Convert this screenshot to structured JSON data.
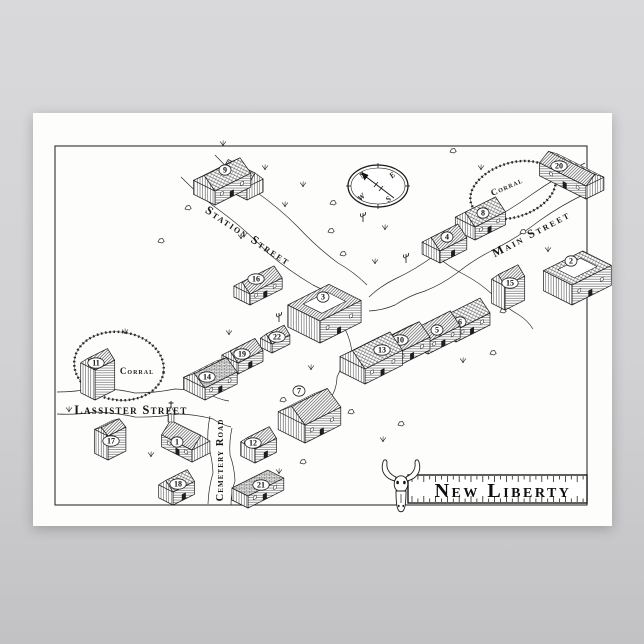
{
  "page": {
    "bg_top": "#d9d9db",
    "bg_bottom": "#c2c2c4"
  },
  "poster": {
    "bg": "#fdfdfc",
    "ink": "#1b1b1b",
    "border_color": "#2f2f2f"
  },
  "map": {
    "title": "New Liberty",
    "streets": [
      {
        "id": "station-street",
        "label": "Station Street"
      },
      {
        "id": "main-street",
        "label": "Main Street"
      },
      {
        "id": "lassister-street",
        "label": "Lassister Street"
      },
      {
        "id": "cemetery-road",
        "label": "Cemetery Road"
      }
    ],
    "corral_label": "Corral",
    "compass_letters": [
      "N",
      "E",
      "S",
      "W"
    ],
    "compass": {
      "cx": 345,
      "cy": 73,
      "rx": 30,
      "ry": 21
    },
    "border": {
      "x": 22,
      "y": 33,
      "w": 532,
      "h": 359
    },
    "banner": {
      "x": 375,
      "y": 362,
      "w": 179,
      "h": 28,
      "tx": 470,
      "ty": 384
    },
    "corrals": [
      {
        "cx": 480,
        "cy": 77,
        "rx": 44,
        "ry": 27,
        "rot": -18,
        "lx": 475,
        "ly": 76,
        "lrot": -24
      },
      {
        "cx": 86,
        "cy": 253,
        "rx": 45,
        "ry": 34,
        "rot": 8,
        "lx": 104,
        "ly": 261,
        "lrot": 0
      }
    ],
    "buildings": [
      {
        "num": "20",
        "o": "se",
        "x": 553,
        "y": 86,
        "a": 52,
        "b": 20,
        "h": 13,
        "r": 7,
        "roof": "a",
        "nx": 526,
        "ny": 53
      },
      {
        "num": "",
        "name": "station-wing",
        "o": "se",
        "x": 214,
        "y": 87,
        "a": 30,
        "b": 18,
        "h": 13,
        "r": 10,
        "roof": "b"
      },
      {
        "num": "9",
        "name": "station",
        "o": "ne",
        "x": 182,
        "y": 92,
        "a": 40,
        "b": 24,
        "h": 14,
        "r": 10,
        "roof": "shake",
        "nx": 192,
        "ny": 57
      },
      {
        "num": "8",
        "o": "ne",
        "x": 442,
        "y": 127,
        "a": 34,
        "b": 22,
        "h": 13,
        "r": 10,
        "roof": "shake",
        "nx": 450,
        "ny": 100
      },
      {
        "num": "4",
        "o": "ne",
        "x": 407,
        "y": 150,
        "a": 30,
        "b": 20,
        "h": 12,
        "r": 9,
        "roof": "a",
        "nx": 414,
        "ny": 124
      },
      {
        "num": "15",
        "o": "ne",
        "x": 472,
        "y": 197,
        "a": 22,
        "b": 15,
        "h": 24,
        "r": 8,
        "roof": "a",
        "nx": 477,
        "ny": 170
      },
      {
        "num": "2",
        "o": "ne",
        "x": 539,
        "y": 192,
        "a": 44,
        "b": 32,
        "h": 20,
        "roof": "shake",
        "style": "flat",
        "court": true,
        "nx": 538,
        "ny": 148
      },
      {
        "num": "16",
        "o": "ne",
        "x": 217,
        "y": 192,
        "a": 36,
        "b": 18,
        "h": 11,
        "r": 8,
        "roof": "a",
        "nx": 223,
        "ny": 166
      },
      {
        "num": "3",
        "o": "ne",
        "x": 287,
        "y": 230,
        "a": 46,
        "b": 36,
        "h": 22,
        "roof": "a",
        "style": "flat",
        "court": true,
        "nx": 290,
        "ny": 184
      },
      {
        "num": "6",
        "o": "ne",
        "x": 423,
        "y": 229,
        "a": 38,
        "b": 22,
        "h": 12,
        "r": 10,
        "roof": "shake",
        "nx": 427,
        "ny": 209
      },
      {
        "num": "5",
        "o": "ne",
        "x": 395,
        "y": 241,
        "a": 36,
        "b": 22,
        "h": 12,
        "r": 10,
        "roof": "a",
        "nx": 404,
        "ny": 217
      },
      {
        "num": "10",
        "o": "ne",
        "x": 363,
        "y": 254,
        "a": 38,
        "b": 24,
        "h": 13,
        "r": 10,
        "roof": "a",
        "nx": 367,
        "ny": 227
      },
      {
        "num": "13",
        "o": "ne",
        "x": 332,
        "y": 271,
        "a": 42,
        "b": 28,
        "h": 15,
        "r": 12,
        "roof": "shake",
        "nx": 349,
        "ny": 237
      },
      {
        "num": "22",
        "o": "ne",
        "x": 239,
        "y": 240,
        "a": 20,
        "b": 13,
        "h": 9,
        "r": 7,
        "roof": "a",
        "nx": 244,
        "ny": 224
      },
      {
        "num": "19",
        "o": "ne",
        "x": 205,
        "y": 261,
        "a": 28,
        "b": 18,
        "h": 11,
        "r": 8,
        "roof": "a",
        "nx": 209,
        "ny": 241
      },
      {
        "num": "14",
        "o": "ne",
        "x": 172,
        "y": 287,
        "a": 36,
        "b": 24,
        "h": 12,
        "r": 9,
        "roof": "brick",
        "nx": 174,
        "ny": 264
      },
      {
        "num": "11",
        "o": "ne",
        "x": 62,
        "y": 287,
        "a": 22,
        "b": 16,
        "h": 30,
        "r": 8,
        "roof": "a",
        "nx": 63,
        "ny": 250
      },
      {
        "num": "7",
        "o": "ne",
        "x": 272,
        "y": 330,
        "a": 40,
        "b": 30,
        "h": 18,
        "r": 12,
        "roof": "a",
        "nx": 266,
        "ny": 278
      },
      {
        "num": "12",
        "o": "ne",
        "x": 222,
        "y": 350,
        "a": 24,
        "b": 16,
        "h": 14,
        "r": 8,
        "roof": "a",
        "nx": 220,
        "ny": 330
      },
      {
        "num": "17",
        "o": "ne",
        "x": 75,
        "y": 347,
        "a": 20,
        "b": 15,
        "h": 24,
        "r": 5,
        "roof": "a",
        "nx": 78,
        "ny": 328
      },
      {
        "num": "1",
        "o": "se",
        "x": 159,
        "y": 349,
        "a": 34,
        "b": 20,
        "h": 12,
        "r": 10,
        "roof": "a",
        "tower": [
          138,
          309
        ],
        "nx": 144,
        "ny": 329
      },
      {
        "num": "18",
        "o": "ne",
        "x": 140,
        "y": 392,
        "a": 24,
        "b": 16,
        "h": 13,
        "r": 8,
        "roof": "shake",
        "nx": 145,
        "ny": 371
      },
      {
        "num": "21",
        "o": "ne",
        "x": 215,
        "y": 395,
        "a": 40,
        "b": 18,
        "h": 12,
        "roof": "brick",
        "style": "flat",
        "nx": 228,
        "ny": 372
      }
    ],
    "roads": [
      {
        "pts": [
          [
            148,
            64
          ],
          [
            190,
            100
          ],
          [
            235,
            140
          ],
          [
            280,
            172
          ],
          [
            312,
            192
          ]
        ],
        "amp": 2.5
      },
      {
        "pts": [
          [
            182,
            42
          ],
          [
            222,
            78
          ],
          [
            265,
            114
          ],
          [
            305,
            150
          ],
          [
            334,
            172
          ]
        ],
        "amp": 2.5
      },
      {
        "pts": [
          [
            552,
            50
          ],
          [
            498,
            82
          ],
          [
            448,
            112
          ],
          [
            402,
            142
          ],
          [
            362,
            166
          ],
          [
            336,
            184
          ]
        ],
        "amp": 2.5
      },
      {
        "pts": [
          [
            554,
            80
          ],
          [
            506,
            108
          ],
          [
            462,
            136
          ],
          [
            424,
            160
          ],
          [
            392,
            178
          ],
          [
            362,
            192
          ],
          [
            336,
            198
          ]
        ],
        "amp": 2.5
      },
      {
        "pts": [
          [
            402,
            142
          ],
          [
            432,
            162
          ],
          [
            460,
            182
          ],
          [
            486,
            202
          ],
          [
            500,
            216
          ]
        ],
        "amp": 2.2
      },
      {
        "pts": [
          [
            24,
            279
          ],
          [
            62,
            275
          ],
          [
            102,
            280
          ],
          [
            142,
            276
          ],
          [
            176,
            281
          ],
          [
            196,
            288
          ]
        ],
        "amp": 2
      },
      {
        "pts": [
          [
            24,
            301
          ],
          [
            62,
            299
          ],
          [
            102,
            304
          ],
          [
            146,
            301
          ],
          [
            180,
            306
          ],
          [
            198,
            314
          ]
        ],
        "amp": 2
      },
      {
        "pts": [
          [
            177,
            303
          ],
          [
            175,
            332
          ],
          [
            180,
            360
          ],
          [
            175,
            391
          ]
        ],
        "amp": 2
      },
      {
        "pts": [
          [
            199,
            315
          ],
          [
            197,
            342
          ],
          [
            202,
            368
          ],
          [
            198,
            392
          ]
        ],
        "amp": 2
      },
      {
        "pts": [
          [
            322,
            192
          ],
          [
            312,
            216
          ],
          [
            319,
            240
          ],
          [
            304,
            264
          ],
          [
            299,
            283
          ]
        ],
        "amp": 2.4
      },
      {
        "pts": [
          [
            60,
            247
          ],
          [
            72,
            262
          ],
          [
            64,
            276
          ]
        ],
        "amp": 1.5
      }
    ],
    "scatter": [
      [
        155,
        95,
        "r"
      ],
      [
        128,
        128,
        "r"
      ],
      [
        190,
        33,
        "g"
      ],
      [
        232,
        57,
        "g"
      ],
      [
        208,
        126,
        "g"
      ],
      [
        252,
        94,
        "g"
      ],
      [
        298,
        118,
        "r"
      ],
      [
        330,
        106,
        "c"
      ],
      [
        352,
        117,
        "g"
      ],
      [
        310,
        141,
        "r"
      ],
      [
        342,
        151,
        "g"
      ],
      [
        373,
        147,
        "c"
      ],
      [
        398,
        131,
        "r"
      ],
      [
        300,
        90,
        "r"
      ],
      [
        270,
        74,
        "g"
      ],
      [
        420,
        38,
        "r"
      ],
      [
        448,
        57,
        "g"
      ],
      [
        490,
        119,
        "r"
      ],
      [
        515,
        139,
        "g"
      ],
      [
        470,
        198,
        "r"
      ],
      [
        447,
        215,
        "g"
      ],
      [
        300,
        221,
        "g"
      ],
      [
        322,
        239,
        "r"
      ],
      [
        278,
        257,
        "g"
      ],
      [
        250,
        287,
        "r"
      ],
      [
        288,
        295,
        "g"
      ],
      [
        318,
        299,
        "r"
      ],
      [
        92,
        221,
        "g"
      ],
      [
        57,
        251,
        "r"
      ],
      [
        36,
        299,
        "g"
      ],
      [
        70,
        329,
        "r"
      ],
      [
        118,
        344,
        "g"
      ],
      [
        152,
        337,
        "r"
      ],
      [
        246,
        361,
        "g"
      ],
      [
        270,
        349,
        "r"
      ],
      [
        350,
        329,
        "g"
      ],
      [
        368,
        311,
        "r"
      ],
      [
        218,
        186,
        "r"
      ],
      [
        246,
        206,
        "c"
      ],
      [
        196,
        222,
        "g"
      ],
      [
        430,
        250,
        "g"
      ],
      [
        460,
        240,
        "r"
      ]
    ]
  }
}
